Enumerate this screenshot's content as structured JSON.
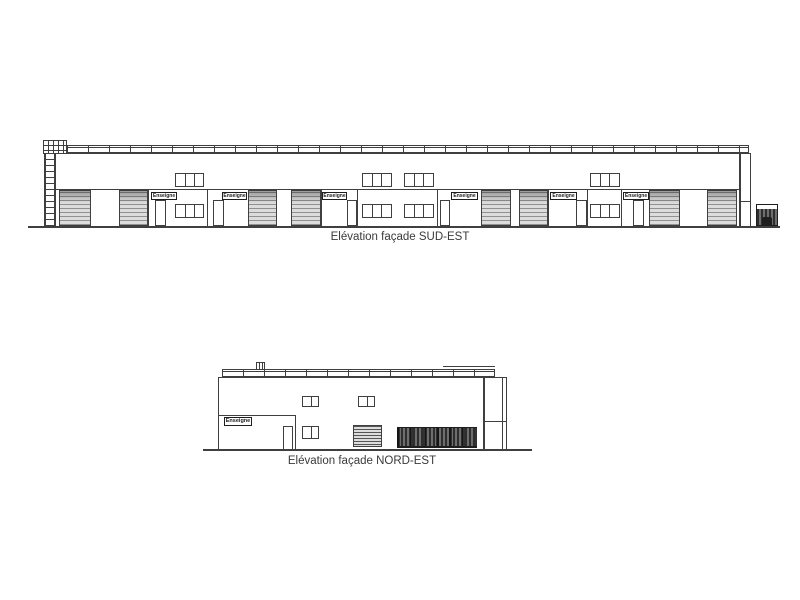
{
  "canvas": {
    "background": "#ffffff",
    "line_color": "#3f3f3f",
    "line_dark": "#1e1e1e",
    "roller_light": "#dcdcdc",
    "roller_dark": "#909090",
    "fence_dark": "#2e2e2e",
    "fence_mid": "#6e6e6e"
  },
  "sud_est": {
    "title": "Elévation façade SUD-EST",
    "sign_label": "Enseigne"
  },
  "nord_est": {
    "title": "Elévation façade NORD-EST",
    "sign_label": "Enseigne"
  }
}
